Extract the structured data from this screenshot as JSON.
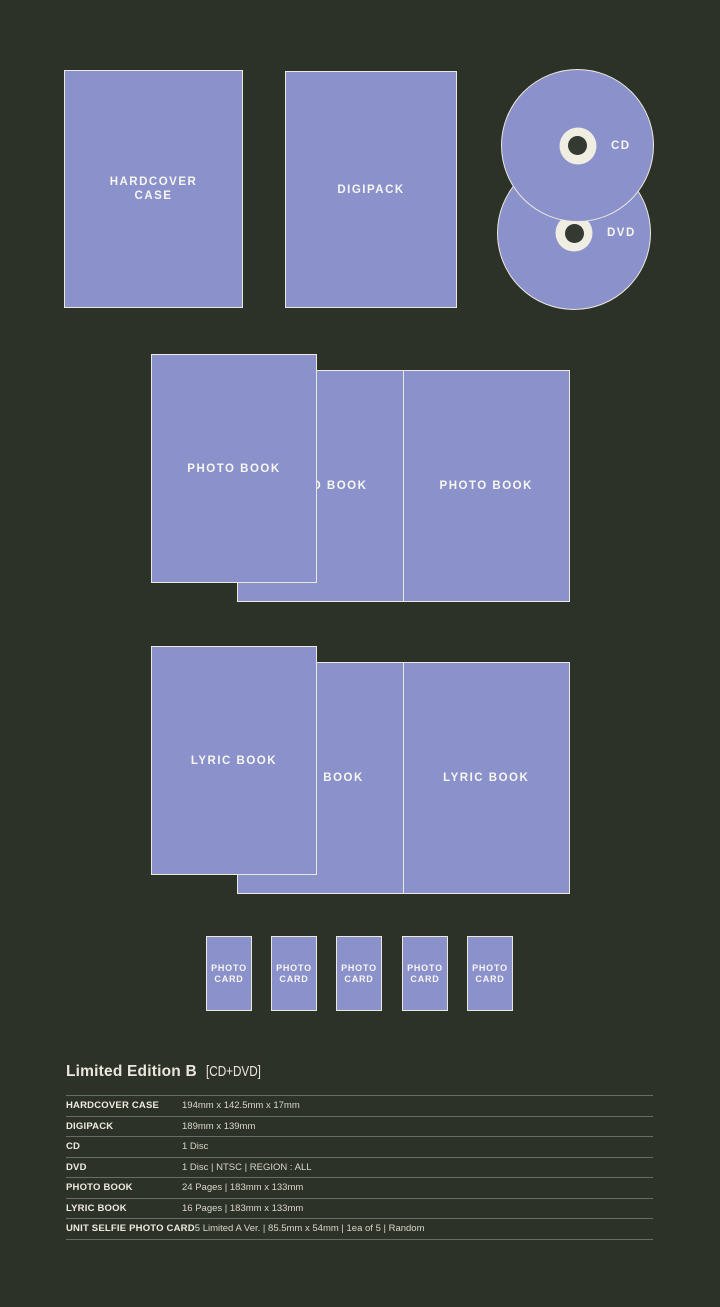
{
  "colors": {
    "background": "#2d3229",
    "shape_fill": "#8a91cb",
    "shape_stroke": "#ebe8dc",
    "shape_text": "#f7f6f0",
    "hub_ring": "#f0eee3",
    "hub_hole": "#343931",
    "title_text": "#e9e7db",
    "table_label_text": "#edebdf",
    "table_value_text": "#d8d6c8"
  },
  "mockups": {
    "hardcover_case": {
      "label_lines": [
        "HARDCOVER",
        "CASE"
      ]
    },
    "digipack": {
      "label": "DIGIPACK"
    },
    "cd": {
      "label": "CD"
    },
    "dvd": {
      "label": "DVD"
    },
    "photo_book": {
      "cover_label": "PHOTO BOOK",
      "spread_left_label": "PHOTO BOOK",
      "spread_right_label": "PHOTO BOOK"
    },
    "lyric_book": {
      "cover_label": "LYRIC BOOK",
      "spread_left_label": "LYRIC BOOK",
      "spread_right_label": "LYRIC BOOK"
    },
    "photo_card": {
      "count": 5,
      "label_lines": [
        "PHOTO",
        "CARD"
      ]
    }
  },
  "edition": {
    "title": "Limited Edition B",
    "subtitle": "[CD+DVD]"
  },
  "spec_table": {
    "rows": [
      {
        "label": "HARDCOVER CASE",
        "value": "194mm x 142.5mm x 17mm"
      },
      {
        "label": "DIGIPACK",
        "value": "189mm x 139mm"
      },
      {
        "label": "CD",
        "value": "1 Disc"
      },
      {
        "label": "DVD",
        "value": "1 Disc | NTSC | REGION : ALL"
      },
      {
        "label": "PHOTO BOOK",
        "value": "24 Pages | 183mm x 133mm"
      },
      {
        "label": "LYRIC BOOK",
        "value": "16 Pages | 183mm x 133mm"
      },
      {
        "label": "UNIT SELFIE PHOTO CARD",
        "value": "5 Limited A Ver. | 85.5mm x 54mm | 1ea of 5 | Random"
      }
    ]
  }
}
